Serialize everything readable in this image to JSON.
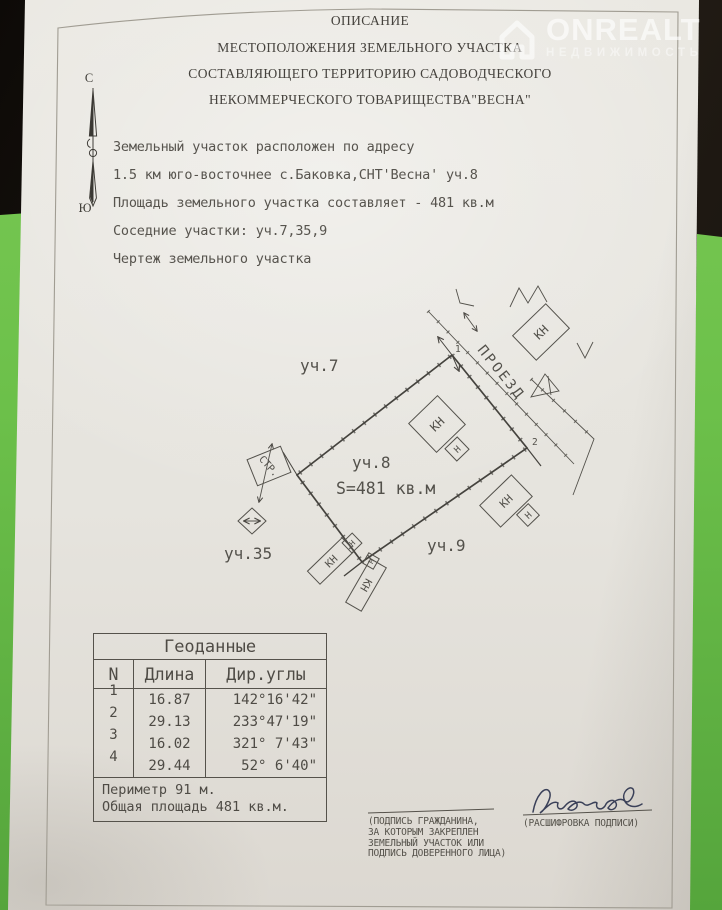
{
  "colors": {
    "paper": "#e7e5df",
    "background_green": "#6cc04a",
    "background_dark": "#1a1510",
    "ink": "#55524b",
    "signature_ink": "#3a4058",
    "watermark_white": "#ffffff"
  },
  "watermark": {
    "brand": "ONREALT",
    "tagline": "НЕДВИЖИМОСТЬ"
  },
  "title": {
    "line1": "ОПИСАНИЕ",
    "line2": "МЕСТОПОЛОЖЕНИЯ ЗЕМЕЛЬНОГО УЧАСТКА",
    "line3": "СОСТАВЛЯЮЩЕГО ТЕРРИТОРИЮ САДОВОДЧЕСКОГО",
    "line4": "НЕКОММЕРЧЕСКОГО ТОВАРИЩЕСТВА\"ВЕСНА\""
  },
  "compass": {
    "north": "С",
    "south": "Ю"
  },
  "body": {
    "line1": "Земельный участок расположен по адресу",
    "line2": "1.5 км юго-восточнее с.Баковка,СНТ'Весна' уч.8",
    "line3": "Площадь земельного участка составляет - 481 кв.м",
    "line4": "Соседние участки: уч.7,35,9",
    "line5": "Чертеж земельного участка"
  },
  "plan": {
    "parcel7_label": "уч.7",
    "parcel8_label": "уч.8",
    "parcel8_area": "S=481 кв.м",
    "parcel9_label": "уч.9",
    "parcel35_label": "уч.35",
    "road_label": "ПРОЕЗД",
    "building_label": "КН",
    "annex_label": "Н",
    "structure_label": "СТР.",
    "point1": "1",
    "point2": "2"
  },
  "geodata_table": {
    "title": "Геоданные",
    "col_n": "N",
    "col_len": "Длина",
    "col_angle": "Дир.углы",
    "rows": [
      {
        "n": "1",
        "len": "16.87",
        "angle": "142°16'42\""
      },
      {
        "n": "2",
        "len": "29.13",
        "angle": "233°47'19\""
      },
      {
        "n": "3",
        "len": "16.02",
        "angle": "321° 7'43\""
      },
      {
        "n": "4",
        "len": "29.44",
        "angle": "52° 6'40\""
      }
    ],
    "perimeter": "Периметр 91 м.",
    "total_area": "Общая площадь 481 кв.м."
  },
  "signature": {
    "name": "Леонова",
    "left_caption_lines": [
      "(ПОДПИСЬ ГРАЖДАНИНА,",
      "ЗА КОТОРЫМ ЗАКРЕПЛЕН",
      "ЗЕМЕЛЬНЫЙ УЧАСТОК ИЛИ",
      "ПОДПИСЬ ДОВЕРЕННОГО ЛИЦА)"
    ],
    "right_caption": "(РАСШИФРОВКА ПОДПИСИ)"
  }
}
